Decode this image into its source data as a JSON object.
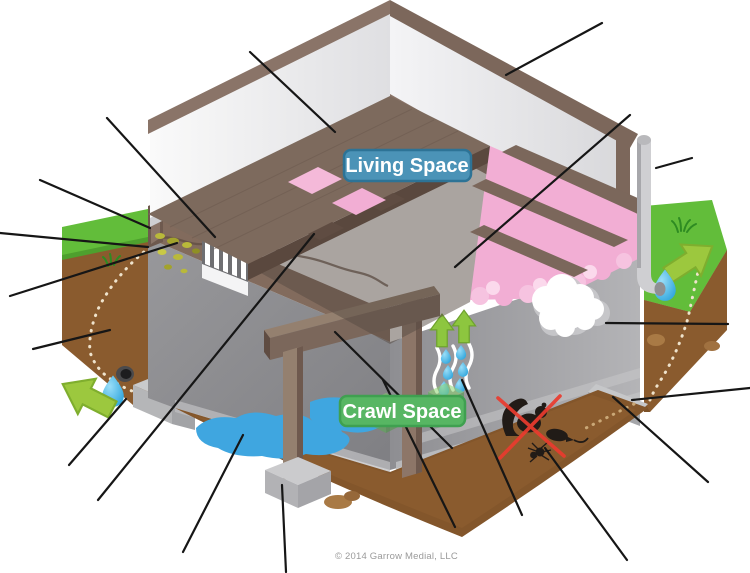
{
  "labels": {
    "living_space": "Living Space",
    "crawl_space": "Crawl Space"
  },
  "copyright": "© 2014 Garrow Medial, LLC",
  "colors": {
    "living_label_fill": "#4b93b7",
    "living_label_border": "#2d7396",
    "crawl_label_fill": "#57b663",
    "crawl_label_border": "#3fa050",
    "arrow_green": "#9cc83e",
    "water_drop_blue": "#35aae0",
    "insulation_pink": "#f2aed4",
    "wood_brown": "#8a7468",
    "concrete_gray": "#a3a3a6",
    "soil_brown": "#8a5b2e",
    "grass_green": "#62bd3a",
    "puddle_blue": "#3fa6e0",
    "pest_x_red": "#ea3b2e",
    "leader_line": "#161616"
  },
  "icons": {
    "vent-icon": "louvered foundation vent",
    "steam-waves-icon": "moisture evaporation waves",
    "up-arrow-icon": "rising moisture arrows",
    "water-drop-icon": "water droplet",
    "down-left-arrow-icon": "water draining away (left)",
    "up-right-arrow-icon": "water draining away (right)",
    "squirrel-icon": "squirrel pest",
    "rat-icon": "rodent pest",
    "bug-icon": "insect pest",
    "red-x-icon": "pests excluded",
    "mold-icon": "mold / efflorescence on wall",
    "pipe-icon": "downspout pipe",
    "drain-icon": "footing drain pipe",
    "grass-tuft-icon": "grass tuft",
    "puddle-icon": "standing water",
    "pier-icon": "column pier block"
  },
  "leader_lines": [
    {
      "x1": 107,
      "y1": 118,
      "x2": 215,
      "y2": 237,
      "target": "vent"
    },
    {
      "x1": 250,
      "y1": 52,
      "x2": 335,
      "y2": 132,
      "target": "wall-interior"
    },
    {
      "x1": 602,
      "y1": 23,
      "x2": 506,
      "y2": 75,
      "target": "top-plate"
    },
    {
      "x1": 98,
      "y1": 500,
      "x2": 314,
      "y2": 234,
      "target": "floor-framing"
    },
    {
      "x1": 630,
      "y1": 115,
      "x2": 455,
      "y2": 267,
      "target": "insulation"
    },
    {
      "x1": 692,
      "y1": 158,
      "x2": 656,
      "y2": 168,
      "target": "downspout-pipe"
    },
    {
      "x1": 40,
      "y1": 180,
      "x2": 150,
      "y2": 228,
      "target": "grade-line"
    },
    {
      "x1": 0,
      "y1": 233,
      "x2": 148,
      "y2": 247,
      "target": "rim-joist"
    },
    {
      "x1": 10,
      "y1": 296,
      "x2": 177,
      "y2": 243,
      "target": "termite-damage"
    },
    {
      "x1": 33,
      "y1": 349,
      "x2": 110,
      "y2": 330,
      "target": "soil-bank"
    },
    {
      "x1": 69,
      "y1": 465,
      "x2": 126,
      "y2": 399,
      "target": "footing-drain"
    },
    {
      "x1": 183,
      "y1": 552,
      "x2": 243,
      "y2": 435,
      "target": "puddle"
    },
    {
      "x1": 286,
      "y1": 572,
      "x2": 282,
      "y2": 485,
      "target": "pier-block"
    },
    {
      "x1": 452,
      "y1": 448,
      "x2": 335,
      "y2": 332,
      "target": "support-beam"
    },
    {
      "x1": 455,
      "y1": 527,
      "x2": 383,
      "y2": 380,
      "target": "dirt-floor"
    },
    {
      "x1": 522,
      "y1": 515,
      "x2": 462,
      "y2": 380,
      "target": "moisture-evaporation"
    },
    {
      "x1": 627,
      "y1": 560,
      "x2": 545,
      "y2": 448,
      "target": "pests"
    },
    {
      "x1": 708,
      "y1": 482,
      "x2": 613,
      "y2": 397,
      "target": "footing-interior"
    },
    {
      "x1": 750,
      "y1": 388,
      "x2": 632,
      "y2": 400,
      "target": "footing-exterior"
    },
    {
      "x1": 728,
      "y1": 324,
      "x2": 606,
      "y2": 323,
      "target": "mold"
    }
  ]
}
